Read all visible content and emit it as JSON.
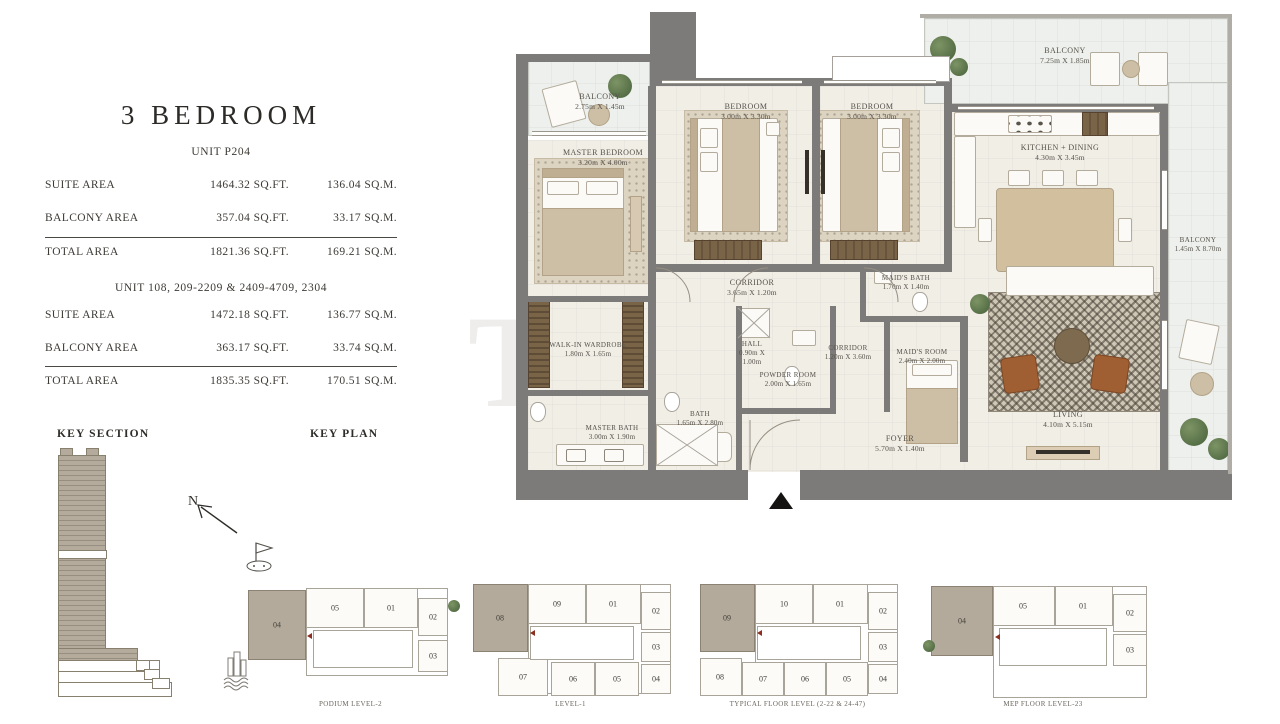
{
  "title": "3 BEDROOM",
  "watermark": "T",
  "area_tables": [
    {
      "unit_label": "UNIT P204",
      "rows": [
        {
          "label": "SUITE AREA",
          "sqft": "1464.32 SQ.FT.",
          "sqm": "136.04 SQ.M."
        },
        {
          "label": "BALCONY AREA",
          "sqft": "357.04 SQ.FT.",
          "sqm": "33.17 SQ.M."
        },
        {
          "label": "TOTAL AREA",
          "sqft": "1821.36 SQ.FT.",
          "sqm": "169.21 SQ.M."
        }
      ]
    },
    {
      "unit_label": "UNIT 108, 209-2209 & 2409-4709, 2304",
      "rows": [
        {
          "label": "SUITE AREA",
          "sqft": "1472.18 SQ.FT.",
          "sqm": "136.77 SQ.M."
        },
        {
          "label": "BALCONY AREA",
          "sqft": "363.17 SQ.FT.",
          "sqm": "33.74 SQ.M."
        },
        {
          "label": "TOTAL AREA",
          "sqft": "1835.35 SQ.FT.",
          "sqm": "170.51 SQ.M."
        }
      ]
    }
  ],
  "key_section": {
    "label": "KEY SECTION"
  },
  "key_plan": {
    "label": "KEY PLAN",
    "north_label": "N"
  },
  "floor_plan": {
    "rooms": [
      {
        "name": "BALCONY",
        "dims": "2.75m X 1.45m"
      },
      {
        "name": "MASTER BEDROOM",
        "dims": "3.20m X 4.00m"
      },
      {
        "name": "BEDROOM",
        "dims": "3.00m X 3.30m"
      },
      {
        "name": "BEDROOM",
        "dims": "3.00m X 3.30m"
      },
      {
        "name": "BALCONY",
        "dims": "7.25m X 1.85m"
      },
      {
        "name": "KITCHEN + DINING",
        "dims": "4.30m X 3.45m"
      },
      {
        "name": "BALCONY",
        "dims": "1.45m X 8.70m"
      },
      {
        "name": "CORRIDOR",
        "dims": "3.65m X 1.20m"
      },
      {
        "name": "HALL",
        "dims": "0.90m X 1.00m"
      },
      {
        "name": "MAID'S BATH",
        "dims": "1.70m X 1.40m"
      },
      {
        "name": "CORRIDOR",
        "dims": "1.20m X 3.60m"
      },
      {
        "name": "MAID'S ROOM",
        "dims": "2.40m X 2.00m"
      },
      {
        "name": "WALK-IN WARDROBE",
        "dims": "1.80m X 1.65m"
      },
      {
        "name": "POWDER ROOM",
        "dims": "2.00m X 1.65m"
      },
      {
        "name": "BATH",
        "dims": "1.65m X 2.80m"
      },
      {
        "name": "MASTER BATH",
        "dims": "3.00m X 1.90m"
      },
      {
        "name": "FOYER",
        "dims": "5.70m X 1.40m"
      },
      {
        "name": "LIVING",
        "dims": "4.10m X 5.15m"
      }
    ]
  },
  "key_plans": [
    {
      "caption": "PODIUM LEVEL-2",
      "highlighted_unit": "04",
      "units": [
        "04",
        "05",
        "01",
        "02",
        "03"
      ]
    },
    {
      "caption": "LEVEL-1",
      "highlighted_unit": "08",
      "units": [
        "08",
        "09",
        "01",
        "02",
        "03",
        "04",
        "05",
        "06",
        "07"
      ]
    },
    {
      "caption": "TYPICAL FLOOR LEVEL (2-22 & 24-47)",
      "highlighted_unit": "09",
      "units": [
        "09",
        "10",
        "01",
        "02",
        "03",
        "04",
        "05",
        "06",
        "07",
        "08"
      ]
    },
    {
      "caption": "MEP FLOOR LEVEL-23",
      "highlighted_unit": "04",
      "units": [
        "04",
        "05",
        "01",
        "02",
        "03"
      ]
    }
  ]
}
